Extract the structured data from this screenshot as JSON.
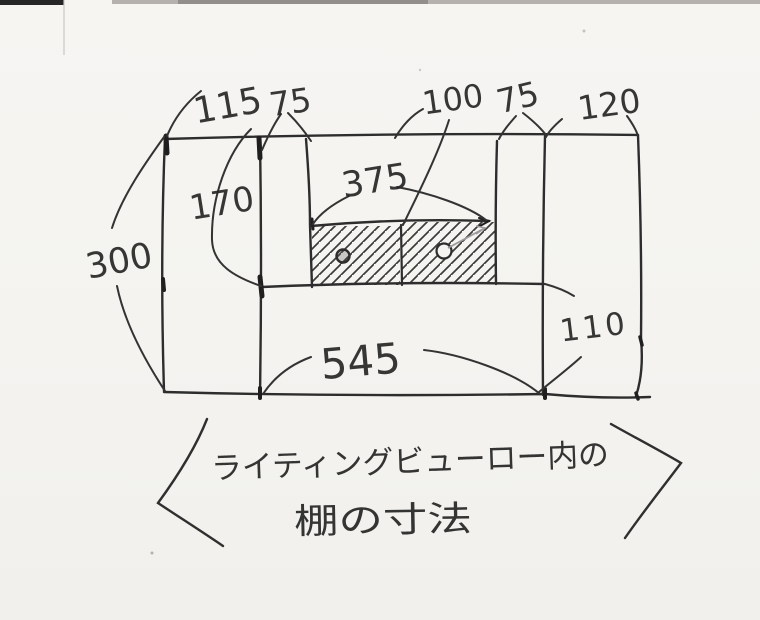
{
  "sketch": {
    "type": "hand-drawn dimensional diagram",
    "caption": {
      "line1": "ライティングビューロー内の",
      "line2": "棚の寸法"
    },
    "dimensions": {
      "top_labels": [
        "115",
        "75",
        "100",
        "75",
        "120"
      ],
      "total_height": "300",
      "inner_left_height": "170",
      "inner_width": "375",
      "bottom_width": "545",
      "lower_right_height": "110"
    },
    "icons": {
      "drawer_knob": "small hand-drawn circle",
      "hatch": "diagonal pencil hatching",
      "angle_brackets": "caption enclosure marks"
    },
    "colors": {
      "paper": "#f5f4f1",
      "ink": "#2d2d2d",
      "pencil": "#9b9b9b",
      "scan_edge": "#a8a5a2"
    }
  }
}
